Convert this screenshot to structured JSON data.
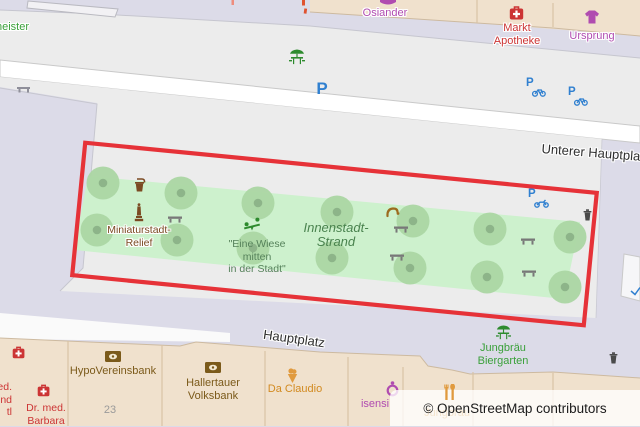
{
  "streets": {
    "unterer_hauptplatz": "Unterer Hauptplatz",
    "hauptplatz": "Hauptplatz"
  },
  "park": {
    "strand_line1": "Innenstadt-",
    "strand_line2": "Strand",
    "monument_line1": "Miniaturstadt-",
    "monument_line2": "Relief",
    "meadow_line1": "\"Eine Wiese",
    "meadow_line2": "mitten",
    "meadow_line3": "in der Stadt\""
  },
  "pois": {
    "neister": "neister",
    "osiander": "Osiander",
    "markt_line1": "Markt",
    "markt_line2": "Apotheke",
    "ursprung": "Ursprung",
    "jungbraeu_line1": "Jungbräu",
    "jungbraeu_line2": "Biergarten",
    "jungbraeu_restaurant": "Jungbräu",
    "hypovereinsbank": "HypoVereinsbank",
    "house_number": "23",
    "hallertauer_line1": "Hallertauer",
    "hallertauer_line2": "Volksbank",
    "da_claudio": "Da Claudio",
    "isensi": "isensi",
    "dr_med_line1": "Dr. med.",
    "dr_med_line2": "Barbara",
    "clipped_line1": "ed.",
    "clipped_line2": "nd",
    "clipped_line3": "tl"
  },
  "icons": {
    "parking_letter": "P"
  },
  "attribution": "© OpenStreetMap contributors",
  "colors": {
    "highlight_red": "#e63238",
    "park_green": "#cdf1cd",
    "tree_green": "#abd6a3",
    "transport_blue": "#3080d0",
    "building_beige": "#f0e1cd",
    "plaza_lavender": "#dcdbe8",
    "pedestrian_gray": "#ececec"
  }
}
